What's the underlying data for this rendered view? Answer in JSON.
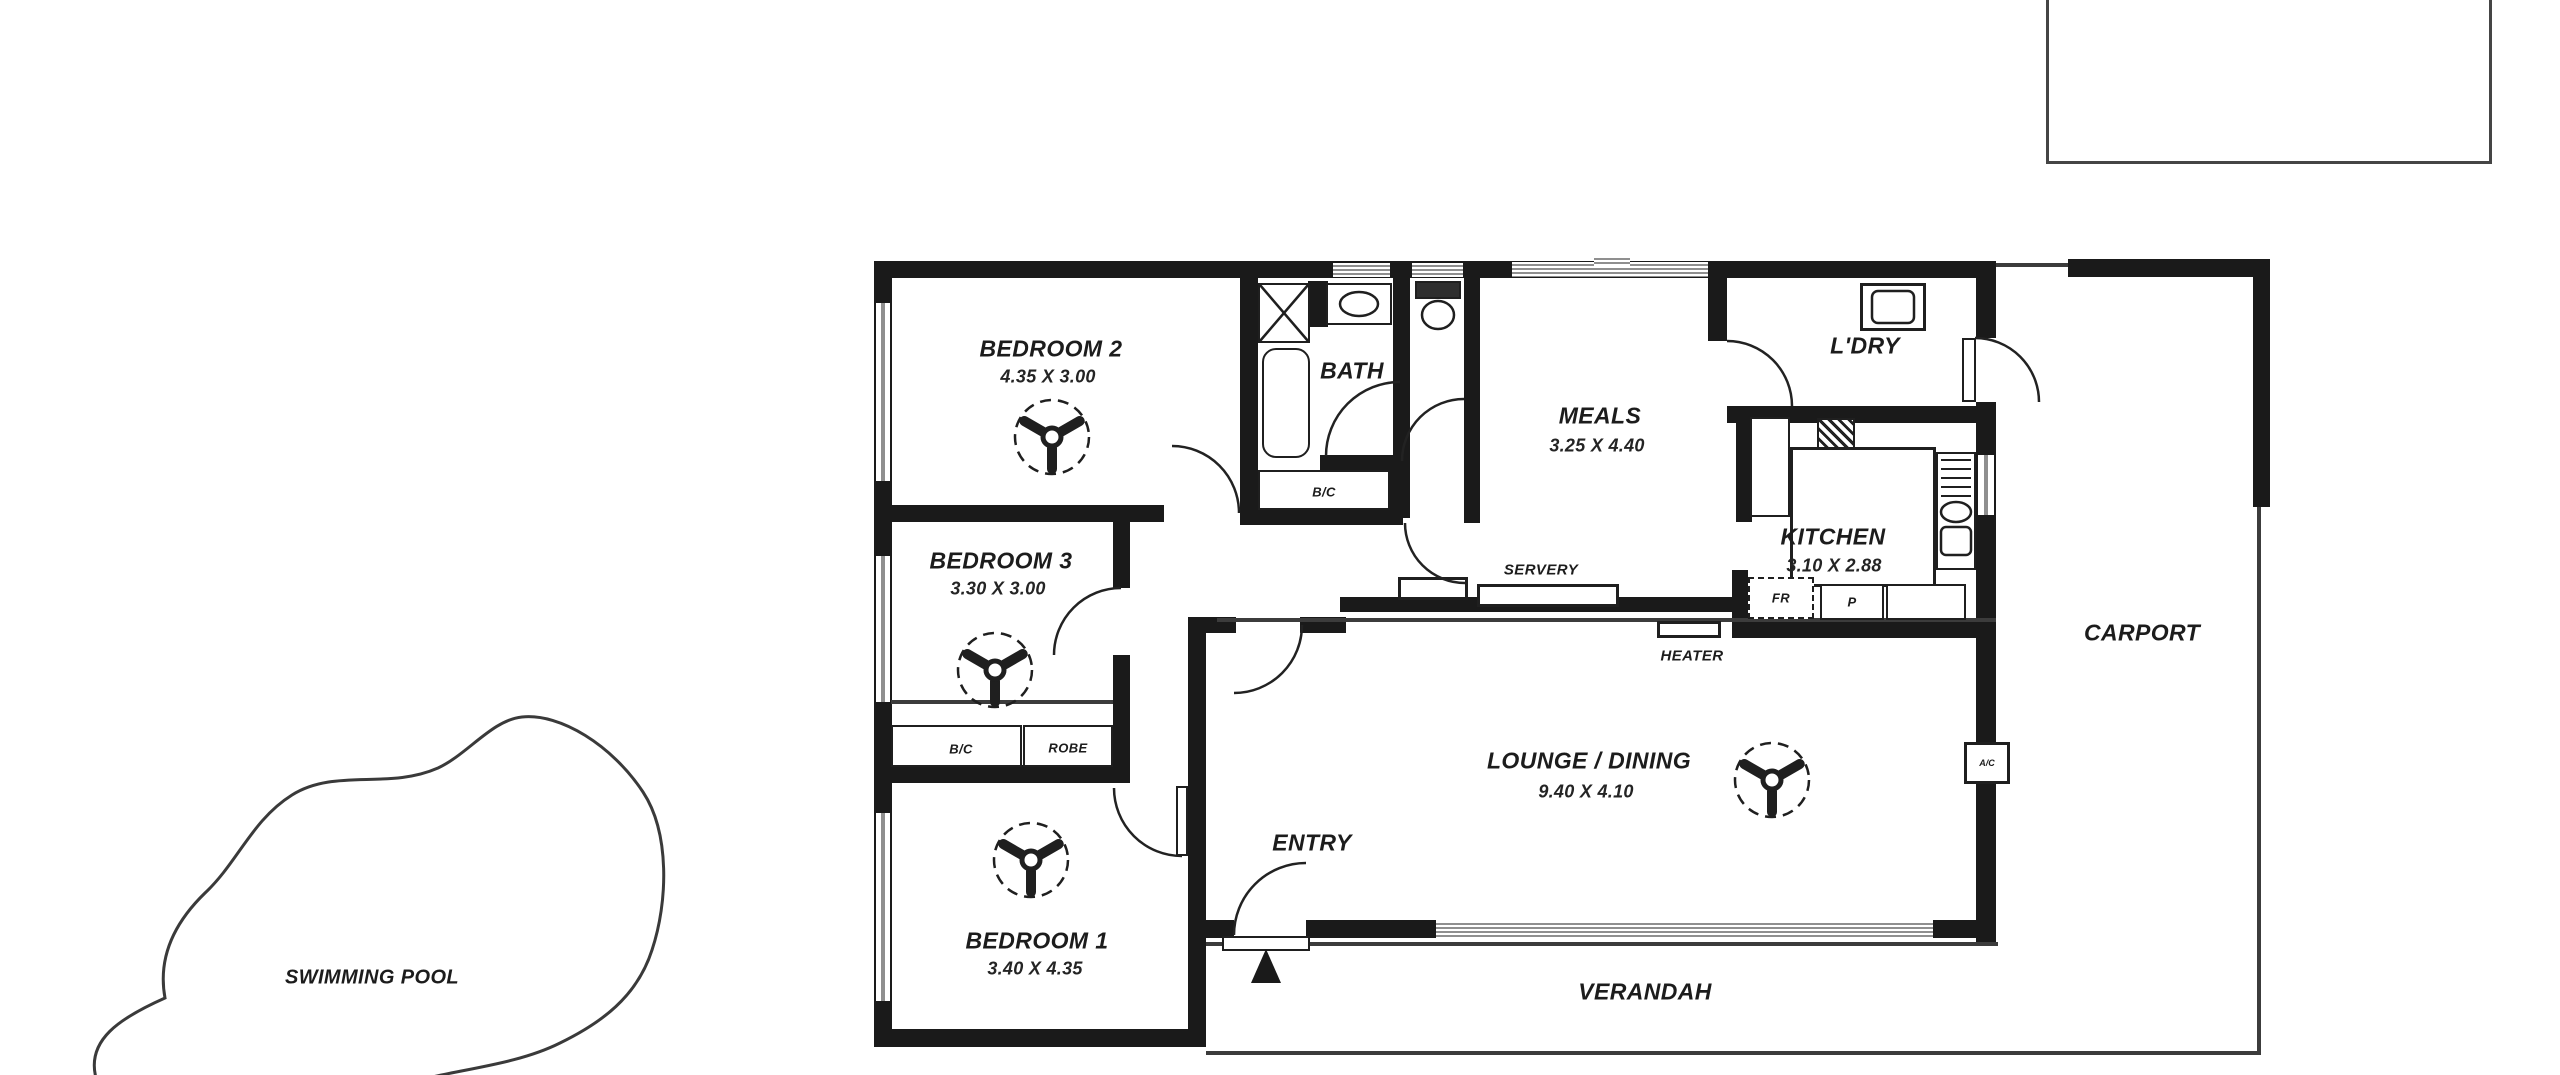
{
  "floor_plan": {
    "rooms": {
      "bedroom2": {
        "name": "BEDROOM 2",
        "dims": "4.35 X 3.00"
      },
      "bedroom3": {
        "name": "BEDROOM 3",
        "dims": "3.30 X 3.00"
      },
      "bedroom1": {
        "name": "BEDROOM 1",
        "dims": "3.40 X 4.35"
      },
      "bath": {
        "name": "BATH"
      },
      "meals": {
        "name": "MEALS",
        "dims": "3.25 X 4.40"
      },
      "laundry": {
        "name": "L'DRY"
      },
      "kitchen": {
        "name": "KITCHEN",
        "dims": "3.10 X 2.88"
      },
      "lounge_dining": {
        "name": "LOUNGE / DINING",
        "dims": "9.40 X 4.10"
      },
      "entry": {
        "name": "ENTRY"
      },
      "verandah": {
        "name": "VERANDAH"
      },
      "carport": {
        "name": "CARPORT"
      },
      "swimming_pool": {
        "name": "SWIMMING POOL"
      }
    },
    "annotations": {
      "servery": "SERVERY",
      "heater": "HEATER",
      "fridge": "FR",
      "pantry": "P",
      "robe": "ROBE",
      "bc_bath": "B/C",
      "bc_bed3": "B/C",
      "air_conditioner": "A/C"
    },
    "colors": {
      "wall": "#1a1a1a",
      "thin_line": "#3c3c3c",
      "window_line": "#8f8f8f",
      "background": "#ffffff"
    }
  }
}
